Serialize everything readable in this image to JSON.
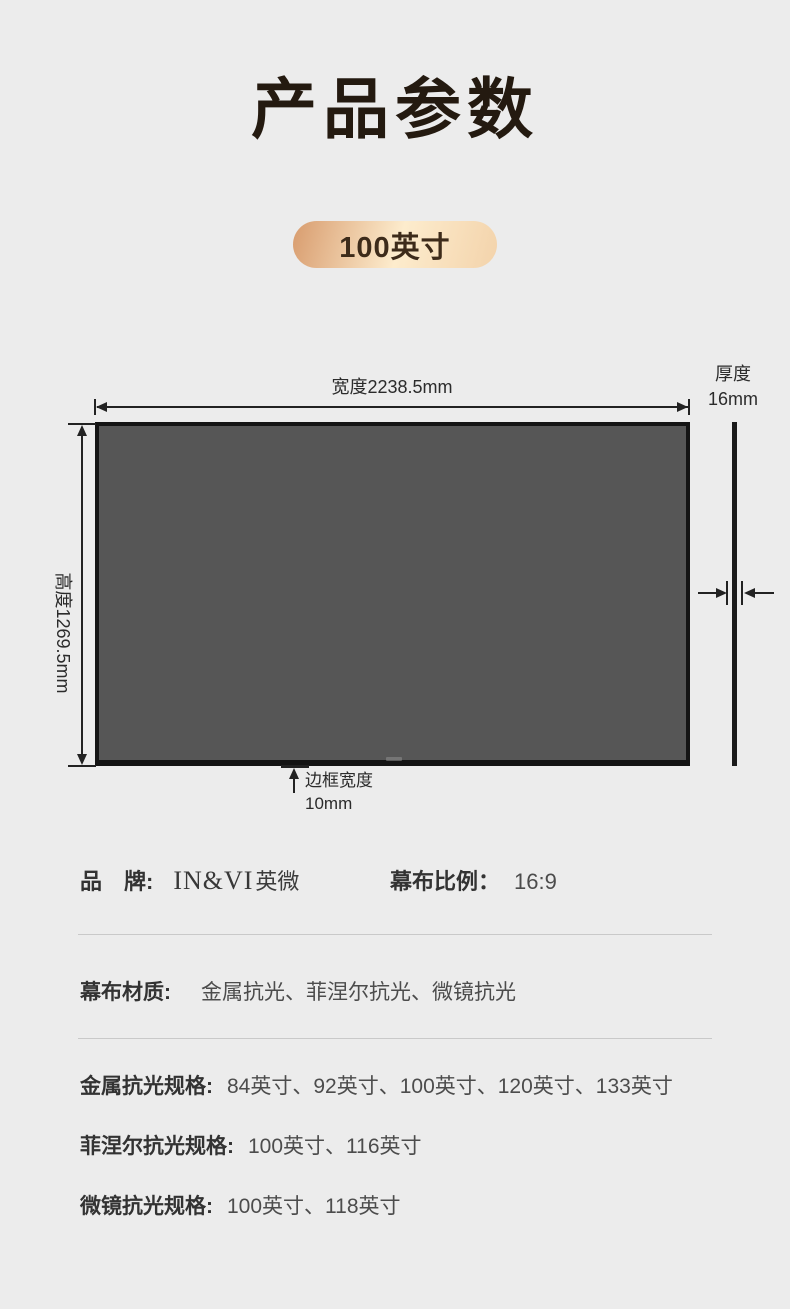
{
  "header": {
    "title": "产品参数",
    "size_badge": "100英寸"
  },
  "diagram": {
    "width_label": "宽度2238.5mm",
    "height_label": "高度1269.5mm",
    "thickness_label": "厚度",
    "thickness_value": "16mm",
    "border_label": "边框宽度",
    "border_value": "10mm"
  },
  "info": {
    "brand_label": "品　牌:",
    "brand_en": "IN&VI",
    "brand_cn": "英微",
    "ratio_label": "幕布比例：",
    "ratio_value": "16:9",
    "material_label": "幕布材质:",
    "material_value": "金属抗光、菲涅尔抗光、微镜抗光",
    "spec_rows": [
      {
        "label": "金属抗光规格:",
        "value": "84英寸、92英寸、100英寸、120英寸、133英寸"
      },
      {
        "label": "菲涅尔抗光规格:",
        "value": "100英寸、116英寸"
      },
      {
        "label": "微镜抗光规格:",
        "value": "100英寸、118英寸"
      }
    ]
  },
  "colors": {
    "background": "#ececec",
    "title": "#241a10",
    "badge_gradient_start": "#d89c6e",
    "badge_gradient_end": "#f3d3ab",
    "screen_fill": "#565656",
    "dimension_line": "#222222"
  }
}
